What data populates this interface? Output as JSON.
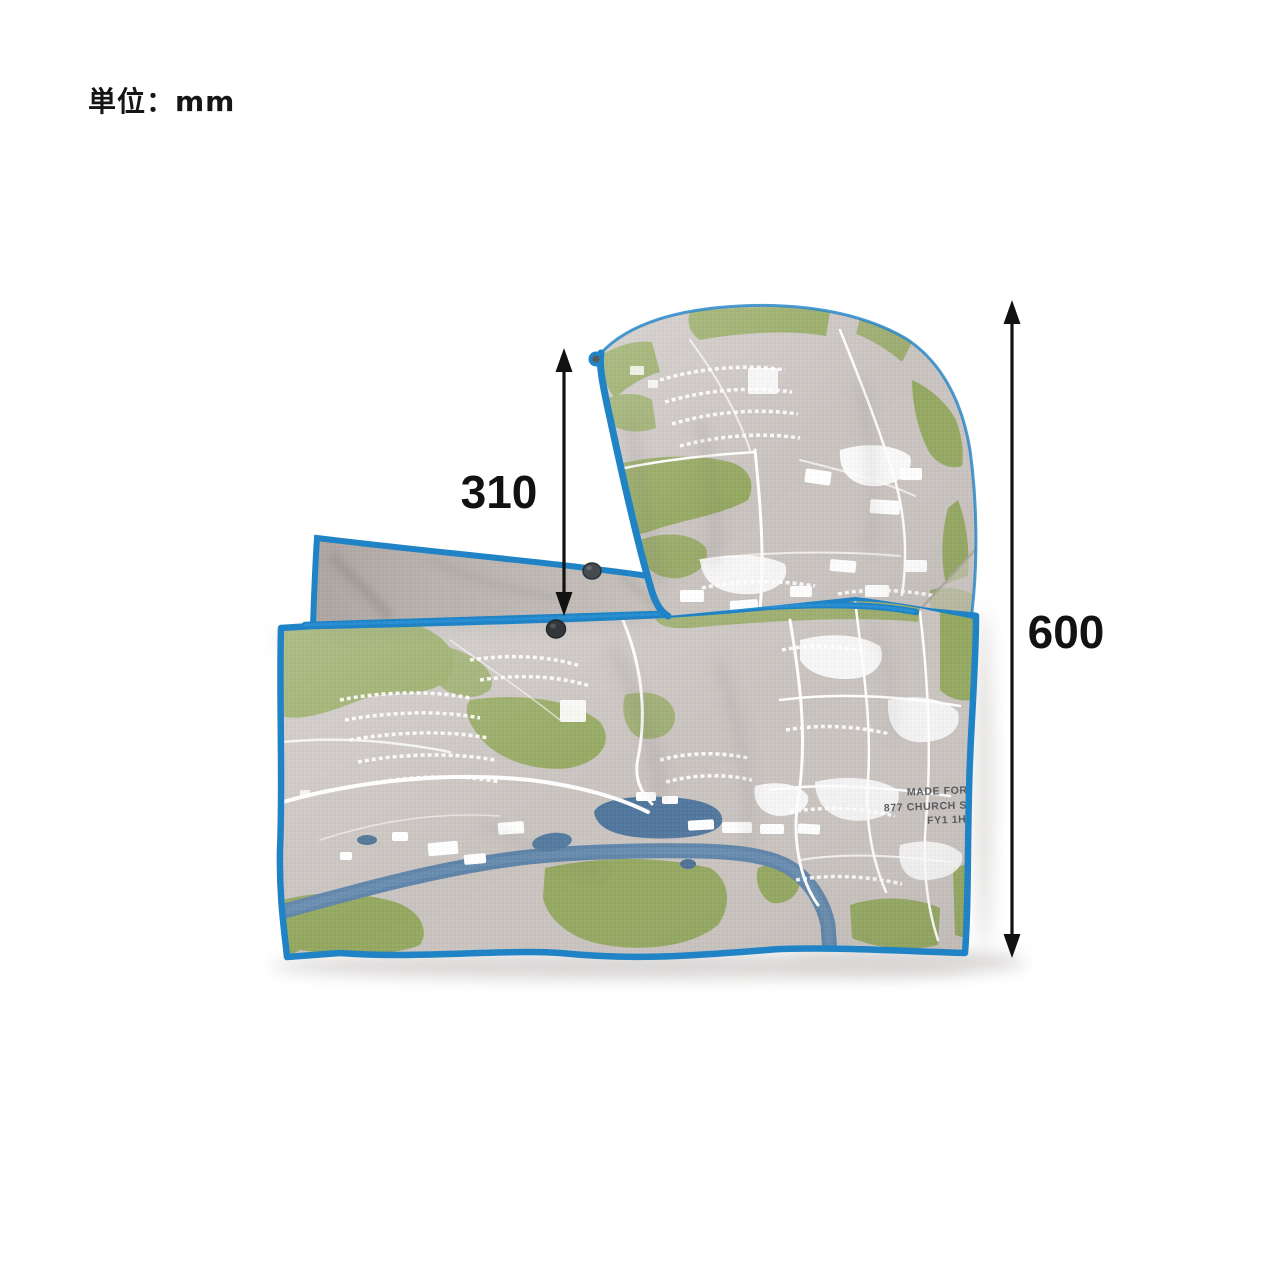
{
  "page": {
    "background": "#ffffff",
    "unit_label": "単位：mm"
  },
  "annotations": {
    "height_310": {
      "value": "310"
    },
    "height_600": {
      "value": "600"
    },
    "arrow_color": "#121212"
  },
  "product": {
    "name": "hooded map-print towel",
    "print_text": {
      "line1": "MADE FOR PO",
      "line2": "877 CHURCH ST. B",
      "line3": "FY1 1HT E"
    },
    "colors": {
      "trim_blue": "#1f83c5",
      "map_base_gray": "#c9c3c0",
      "map_green": "#93a75f",
      "map_water": "#5d83a8",
      "map_roads": "#ffffff",
      "flap_back_gray": "#b5aeab",
      "snap_button": "#3a3e43"
    }
  }
}
